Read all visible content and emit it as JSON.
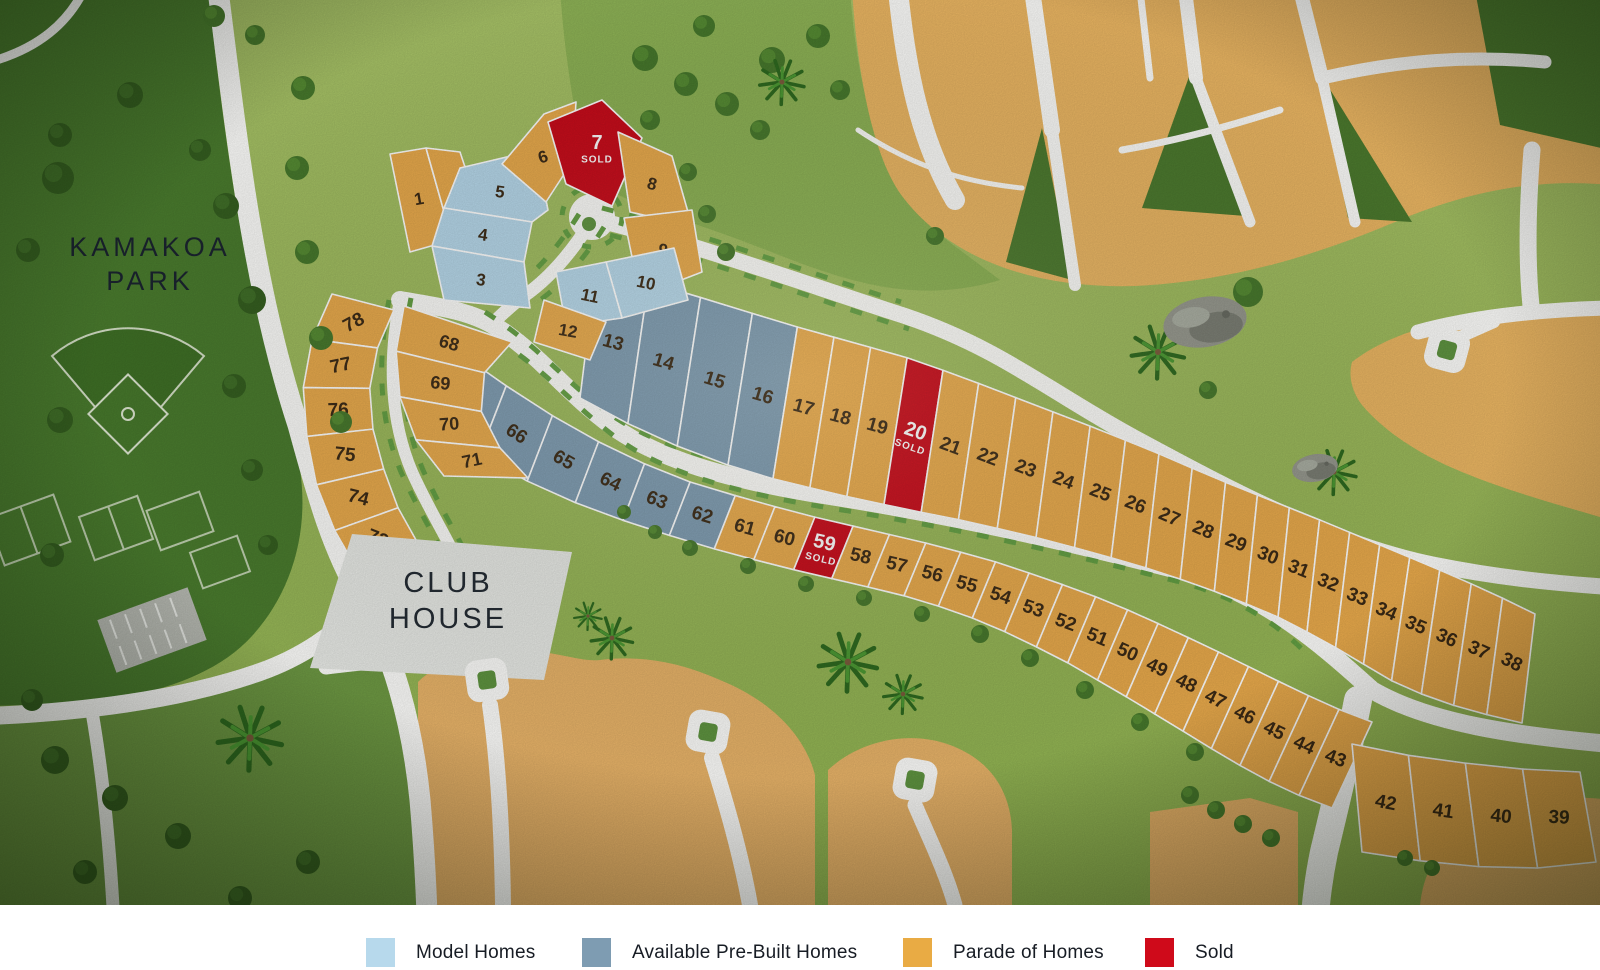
{
  "park": {
    "line1": "KAMAKOA",
    "line2": "PARK"
  },
  "club_house": {
    "line1": "CLUB",
    "line2": "HOUSE"
  },
  "sold_label": "SOLD",
  "status_colors": {
    "model": "#b7d9ec",
    "prebuilt": "#7e9cb2",
    "parade": "#eaab4c",
    "sold": "#c90b1a"
  },
  "legend": {
    "items": [
      {
        "key": "model",
        "label": "Model Homes",
        "color": "#b7d9ec"
      },
      {
        "key": "prebuilt",
        "label": "Available Pre-Built Homes",
        "color": "#7e9cb2"
      },
      {
        "key": "parade",
        "label": "Parade of Homes",
        "color": "#e9ab44"
      },
      {
        "key": "sold",
        "label": "Sold",
        "color": "#cf0a1a"
      }
    ]
  },
  "lots": [
    {
      "n": 1,
      "status": "parade"
    },
    {
      "n": 2,
      "status": "parade"
    },
    {
      "n": 3,
      "status": "model"
    },
    {
      "n": 4,
      "status": "model"
    },
    {
      "n": 5,
      "status": "model"
    },
    {
      "n": 6,
      "status": "parade"
    },
    {
      "n": 7,
      "status": "sold"
    },
    {
      "n": 8,
      "status": "parade"
    },
    {
      "n": 9,
      "status": "parade"
    },
    {
      "n": 10,
      "status": "model"
    },
    {
      "n": 11,
      "status": "model"
    },
    {
      "n": 12,
      "status": "parade"
    },
    {
      "n": 13,
      "status": "prebuilt"
    },
    {
      "n": 14,
      "status": "prebuilt"
    },
    {
      "n": 15,
      "status": "prebuilt"
    },
    {
      "n": 16,
      "status": "prebuilt"
    },
    {
      "n": 17,
      "status": "parade"
    },
    {
      "n": 18,
      "status": "parade"
    },
    {
      "n": 19,
      "status": "parade"
    },
    {
      "n": 20,
      "status": "sold"
    },
    {
      "n": 21,
      "status": "parade"
    },
    {
      "n": 22,
      "status": "parade"
    },
    {
      "n": 23,
      "status": "parade"
    },
    {
      "n": 24,
      "status": "parade"
    },
    {
      "n": 25,
      "status": "parade"
    },
    {
      "n": 26,
      "status": "parade"
    },
    {
      "n": 27,
      "status": "parade"
    },
    {
      "n": 28,
      "status": "parade"
    },
    {
      "n": 29,
      "status": "parade"
    },
    {
      "n": 30,
      "status": "parade"
    },
    {
      "n": 31,
      "status": "parade"
    },
    {
      "n": 32,
      "status": "parade"
    },
    {
      "n": 33,
      "status": "parade"
    },
    {
      "n": 34,
      "status": "parade"
    },
    {
      "n": 35,
      "status": "parade"
    },
    {
      "n": 36,
      "status": "parade"
    },
    {
      "n": 37,
      "status": "parade"
    },
    {
      "n": 38,
      "status": "parade"
    },
    {
      "n": 39,
      "status": "parade"
    },
    {
      "n": 40,
      "status": "parade"
    },
    {
      "n": 41,
      "status": "parade"
    },
    {
      "n": 42,
      "status": "parade"
    },
    {
      "n": 43,
      "status": "parade"
    },
    {
      "n": 44,
      "status": "parade"
    },
    {
      "n": 45,
      "status": "parade"
    },
    {
      "n": 46,
      "status": "parade"
    },
    {
      "n": 47,
      "status": "parade"
    },
    {
      "n": 48,
      "status": "parade"
    },
    {
      "n": 49,
      "status": "parade"
    },
    {
      "n": 50,
      "status": "parade"
    },
    {
      "n": 51,
      "status": "parade"
    },
    {
      "n": 52,
      "status": "parade"
    },
    {
      "n": 53,
      "status": "parade"
    },
    {
      "n": 54,
      "status": "parade"
    },
    {
      "n": 55,
      "status": "parade"
    },
    {
      "n": 56,
      "status": "parade"
    },
    {
      "n": 57,
      "status": "parade"
    },
    {
      "n": 58,
      "status": "parade"
    },
    {
      "n": 59,
      "status": "sold"
    },
    {
      "n": 60,
      "status": "parade"
    },
    {
      "n": 61,
      "status": "parade"
    },
    {
      "n": 62,
      "status": "prebuilt"
    },
    {
      "n": 63,
      "status": "prebuilt"
    },
    {
      "n": 64,
      "status": "prebuilt"
    },
    {
      "n": 65,
      "status": "prebuilt"
    },
    {
      "n": 66,
      "status": "prebuilt"
    },
    {
      "n": 67,
      "status": "prebuilt"
    },
    {
      "n": 68,
      "status": "parade"
    },
    {
      "n": 69,
      "status": "parade"
    },
    {
      "n": 70,
      "status": "parade"
    },
    {
      "n": 71,
      "status": "parade"
    },
    {
      "n": 72,
      "status": "parade"
    },
    {
      "n": 73,
      "status": "parade"
    },
    {
      "n": 74,
      "status": "parade"
    },
    {
      "n": 75,
      "status": "parade"
    },
    {
      "n": 76,
      "status": "parade"
    },
    {
      "n": 77,
      "status": "parade"
    },
    {
      "n": 78,
      "status": "parade"
    }
  ]
}
